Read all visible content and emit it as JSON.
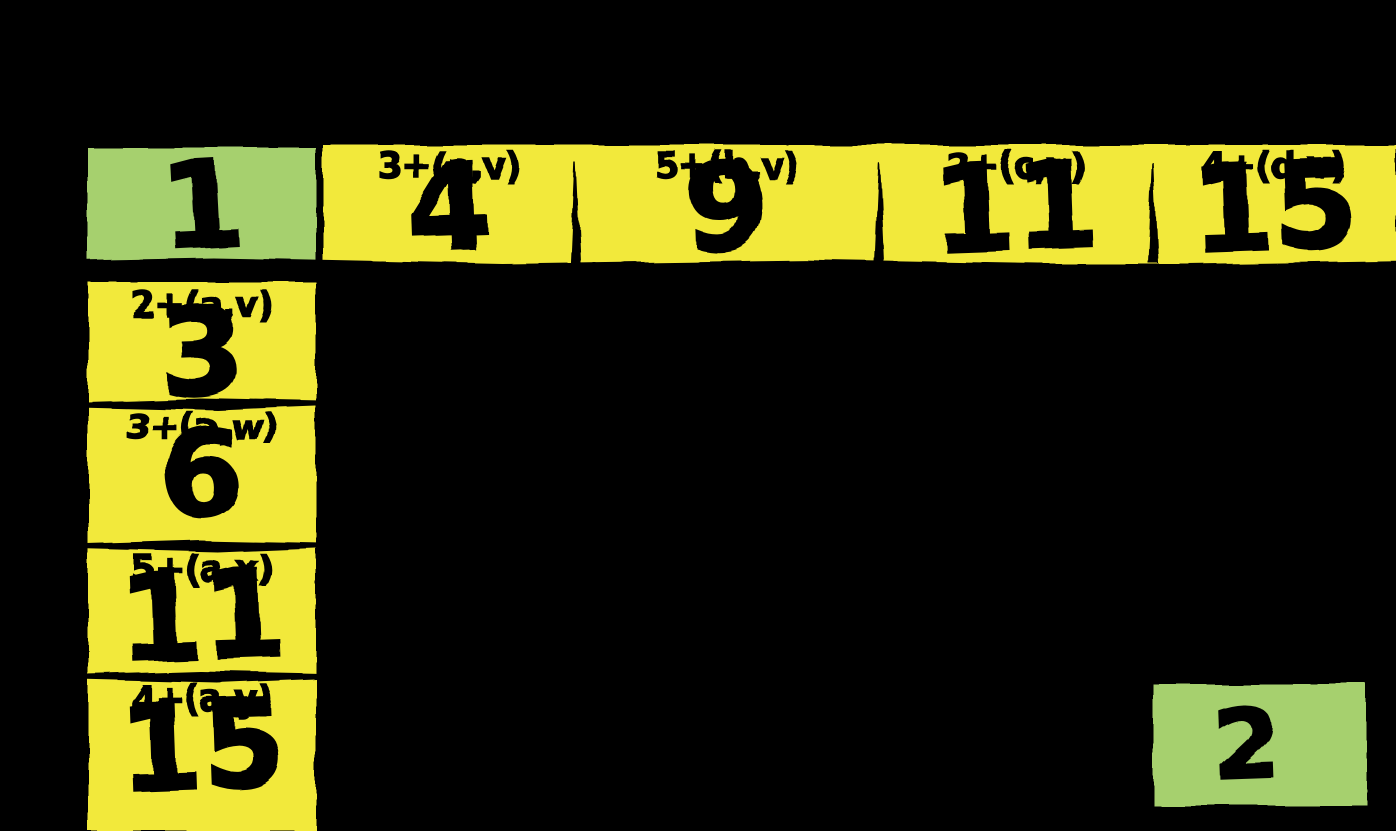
{
  "colors": {
    "cell_yellow": "#f2e93b",
    "cell_green": "#a6d06e",
    "ink": "#000000",
    "background": "#000000"
  },
  "top_row": {
    "start_cell": {
      "value": "1"
    },
    "cells": [
      {
        "label": "3+(a,v)",
        "value": "4"
      },
      {
        "label": "5+(b,v)",
        "value": "9"
      },
      {
        "label": "2+(c,v)",
        "value": "11"
      },
      {
        "label": "4+(d,v)",
        "value": "15"
      }
    ]
  },
  "left_column": {
    "cells": [
      {
        "label": "2+(a,v)",
        "value": "3"
      },
      {
        "label": "3+(a,w)",
        "value": "6"
      },
      {
        "label": "5+(a,x)",
        "value": "11"
      },
      {
        "label": "4+(a,y)",
        "value": "15"
      }
    ]
  },
  "bottom_right": {
    "cell": {
      "value": "2"
    }
  }
}
